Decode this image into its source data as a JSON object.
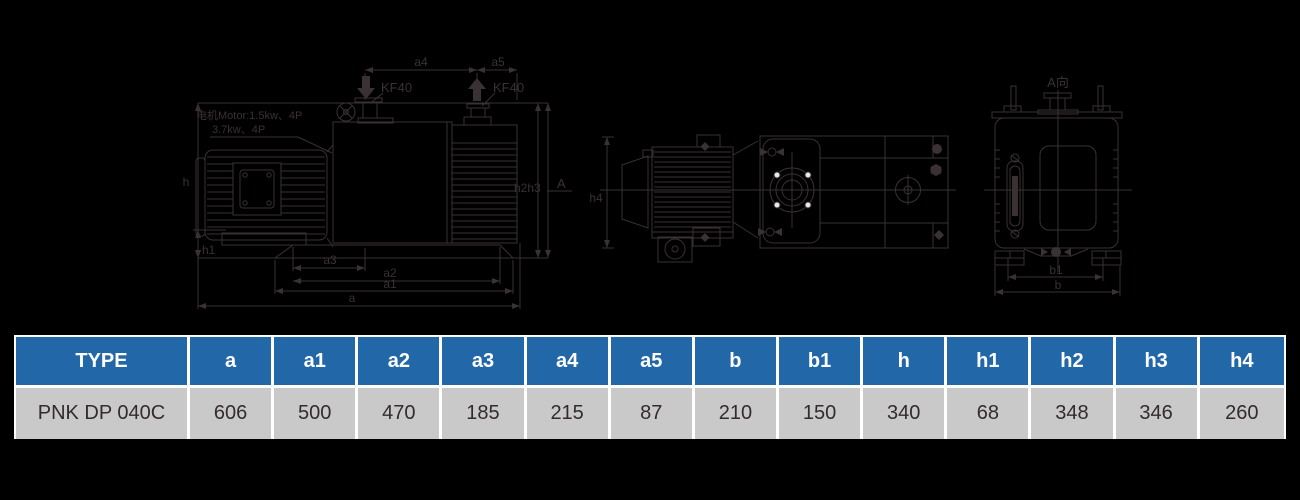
{
  "colors": {
    "background": "#000000",
    "line": "#3a3133",
    "table_header_bg": "#2268a9",
    "table_header_text": "#ffffff",
    "table_row_bg": "#c9c9c9",
    "table_row_text": "#332b2c",
    "table_border": "#ffffff"
  },
  "drawing": {
    "side_view": {
      "motor_note_line1": "电机Motor:1.5kw、4P",
      "motor_note_line2": "3.7kw、4P",
      "dim_a4": "a4",
      "dim_a5": "a5",
      "inlet_flange": "KF40",
      "exhaust_flange": "KF40",
      "dim_h": "h",
      "dim_h1": "h1",
      "dim_h2h3": "h2h3",
      "section_label": "A",
      "dim_a3": "a3",
      "dim_a2": "a2",
      "dim_a1": "a1",
      "dim_a": "a"
    },
    "top_view": {
      "dim_h4": "h4"
    },
    "end_view": {
      "view_label": "A向",
      "dim_b1": "b1",
      "dim_b": "b"
    }
  },
  "table": {
    "headers": [
      "TYPE",
      "a",
      "a1",
      "a2",
      "a3",
      "a4",
      "a5",
      "b",
      "b1",
      "h",
      "h1",
      "h2",
      "h3",
      "h4"
    ],
    "rows": [
      {
        "type": "PNK DP 040C",
        "values": [
          "606",
          "500",
          "470",
          "185",
          "215",
          "87",
          "210",
          "150",
          "340",
          "68",
          "348",
          "346",
          "260"
        ]
      }
    ]
  }
}
